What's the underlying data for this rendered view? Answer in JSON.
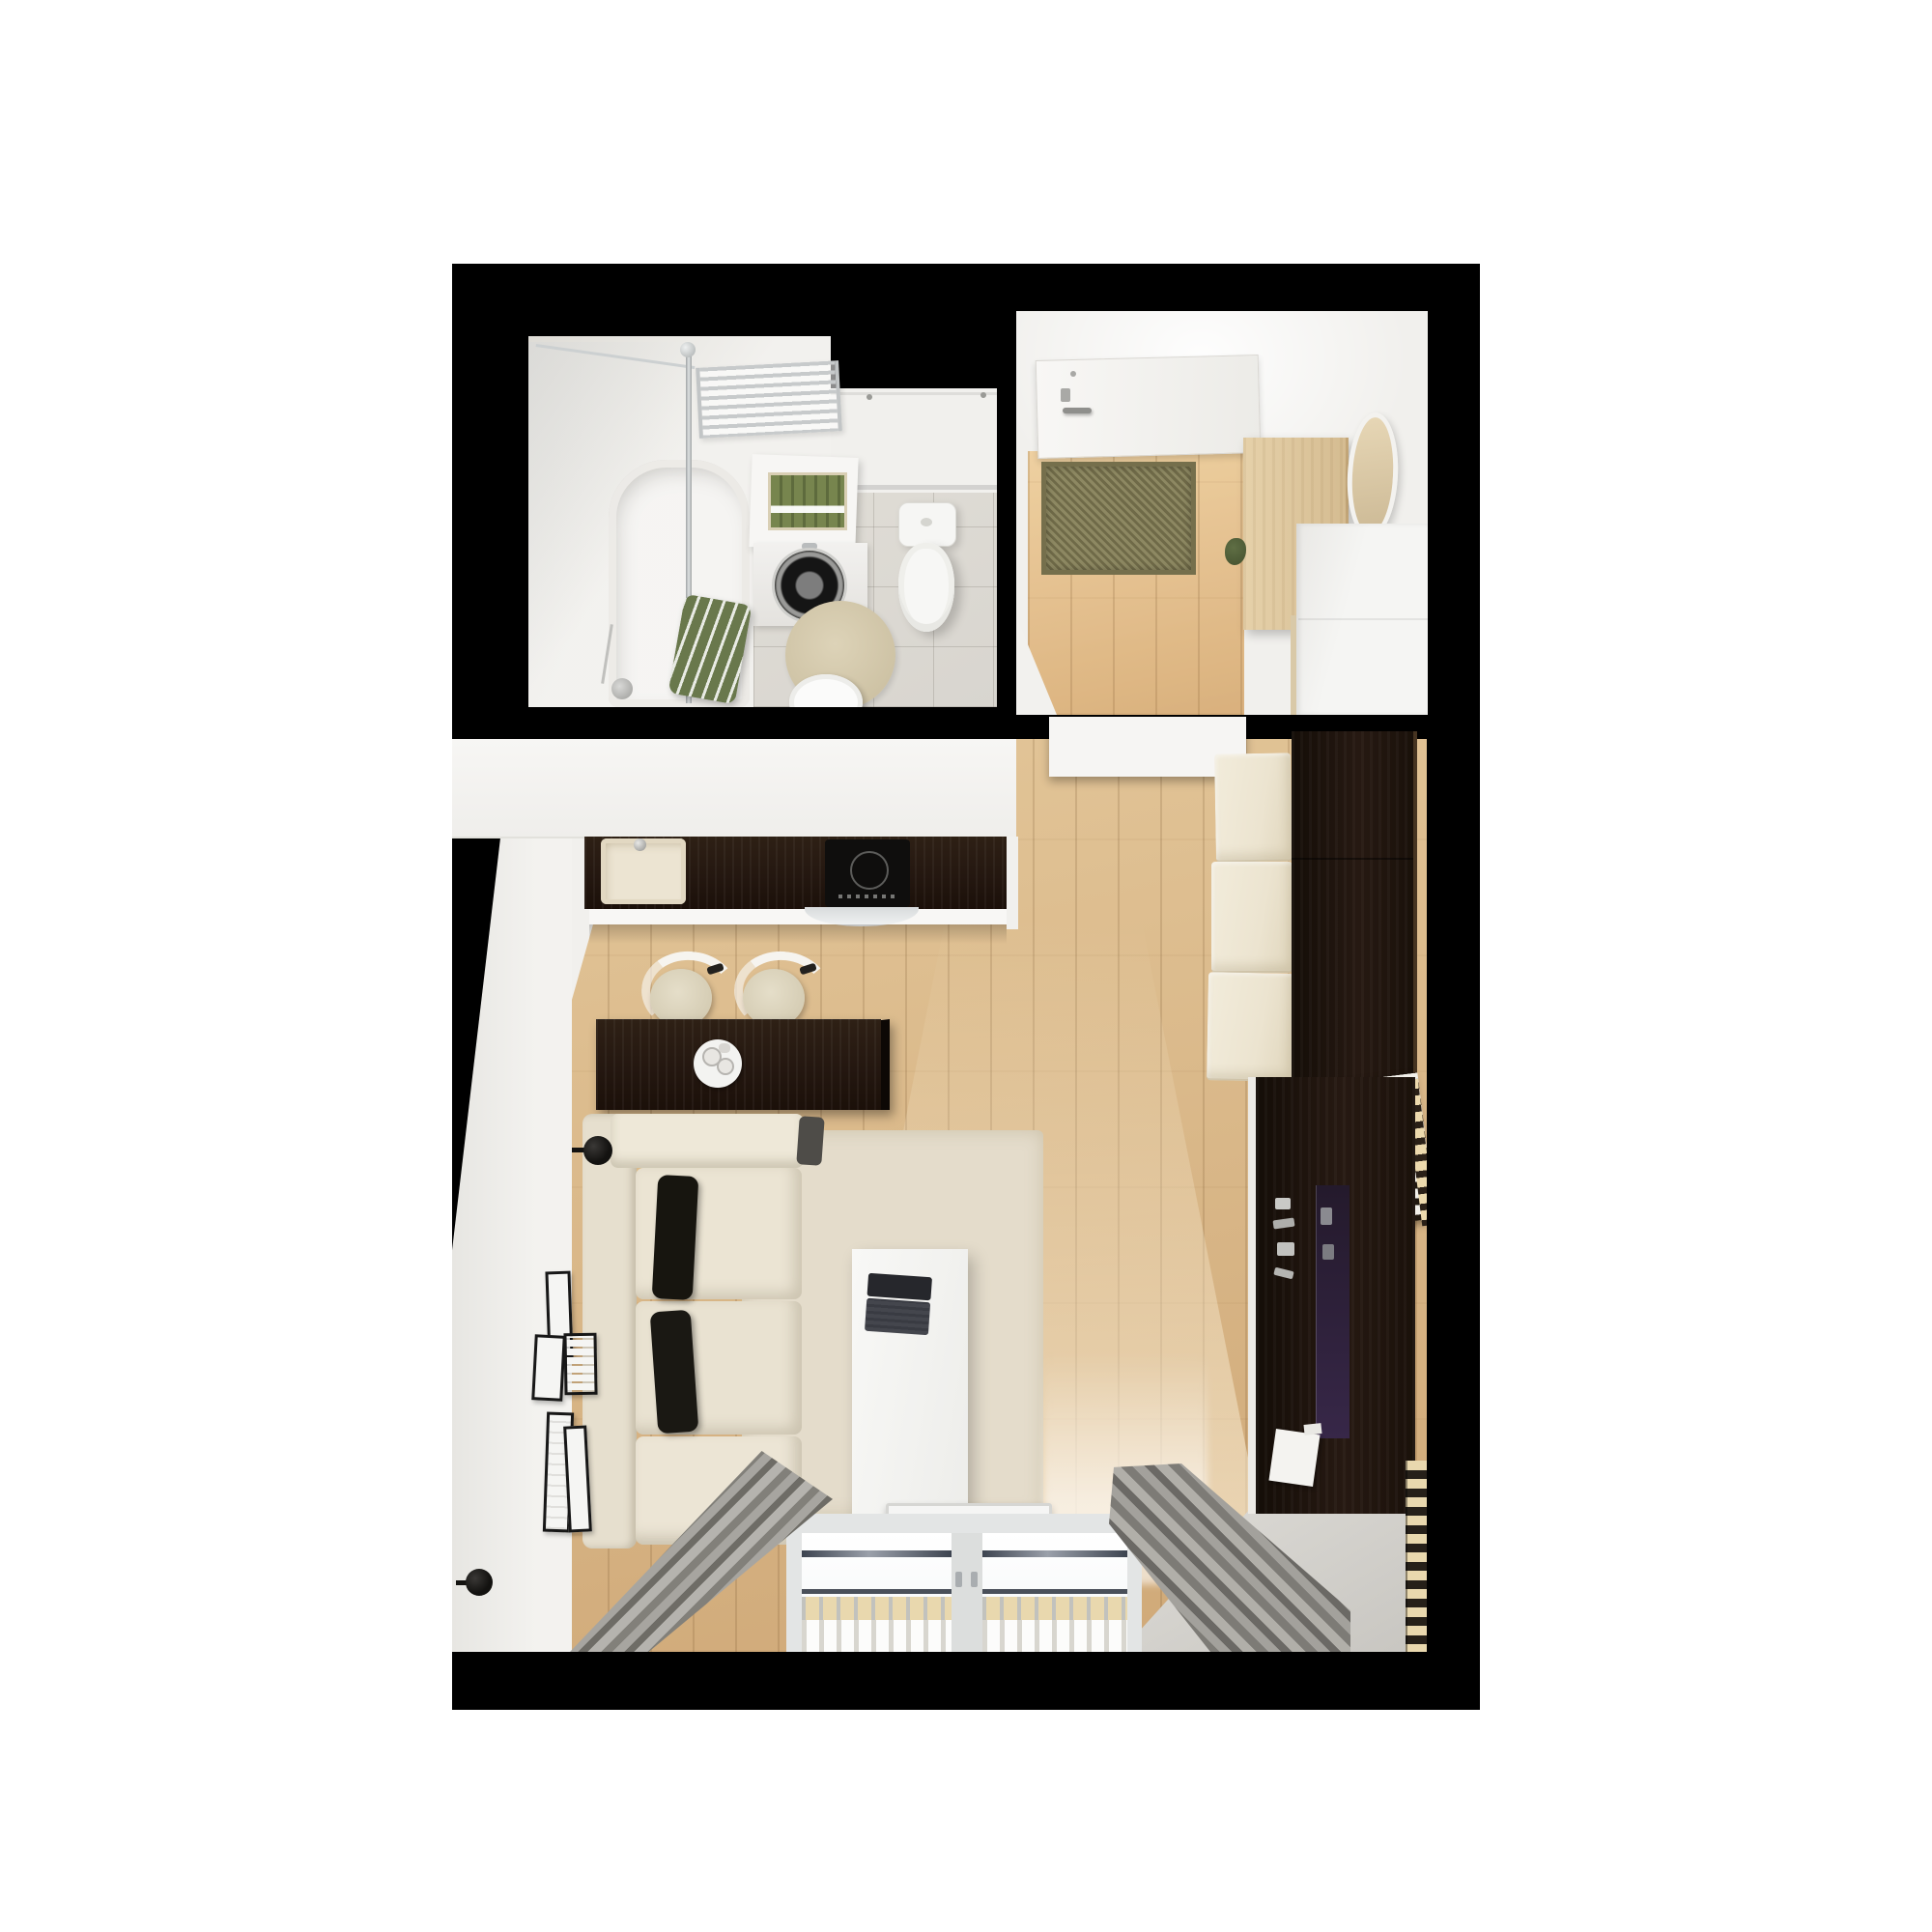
{
  "scene": {
    "description": "Top-down 3D rendered floor plan of a compact studio apartment",
    "style": "photorealistic interior visualization, no visible text",
    "page_background": "#ffffff",
    "plan_background": "#000000"
  },
  "palette": {
    "wall": "#f1f0ed",
    "wood": "#cfa877",
    "wood_light": "#e3c699",
    "tile": "#d8d5cf",
    "wenge": "#241710",
    "dark_wood": "#1a110a",
    "cream": "#ece4d0",
    "sofa": "#e9e2d1",
    "curtain": "#8a8883",
    "rug": "#e4dccb",
    "green": "#6e7c50",
    "rail_beige": "#e9d8ae",
    "plan_bg": "#000000"
  },
  "rooms": {
    "bathroom": {
      "label": "Bathroom",
      "items": [
        "shower enclosure",
        "bathtub",
        "towel radiator",
        "hand shower",
        "storage cabinet",
        "rolled green towels",
        "washing machine",
        "toilet",
        "round rug",
        "stool",
        "hanging green towel",
        "tiled floor"
      ]
    },
    "entry": {
      "label": "Entry hall",
      "label_items": "front door, doormat, wardrobe, mirror, shoe cabinet",
      "items": [
        "front door",
        "woven doormat",
        "wardrobe",
        "oval floor mirror",
        "plant",
        "white shoe cabinet",
        "wood floor"
      ]
    },
    "living": {
      "label": "Living room with kitchenette",
      "items": [
        "kitchen counter",
        "sink",
        "induction cooktop",
        "cooker hood",
        "bar table",
        "two bar stools",
        "serving tray with cups",
        "three-seat sofa",
        "black cushions",
        "coffee table",
        "laptop",
        "area rug",
        "gallery wall frames",
        "two wall sconces",
        "dark wardrobe",
        "upholstered cream panels",
        "white slatted shelf",
        "desk with accessories",
        "paper sheet",
        "vertical radiator",
        "panel radiator",
        "balcony window",
        "balcony railing",
        "gray curtains",
        "sheer curtain",
        "sunlight patch"
      ]
    }
  }
}
